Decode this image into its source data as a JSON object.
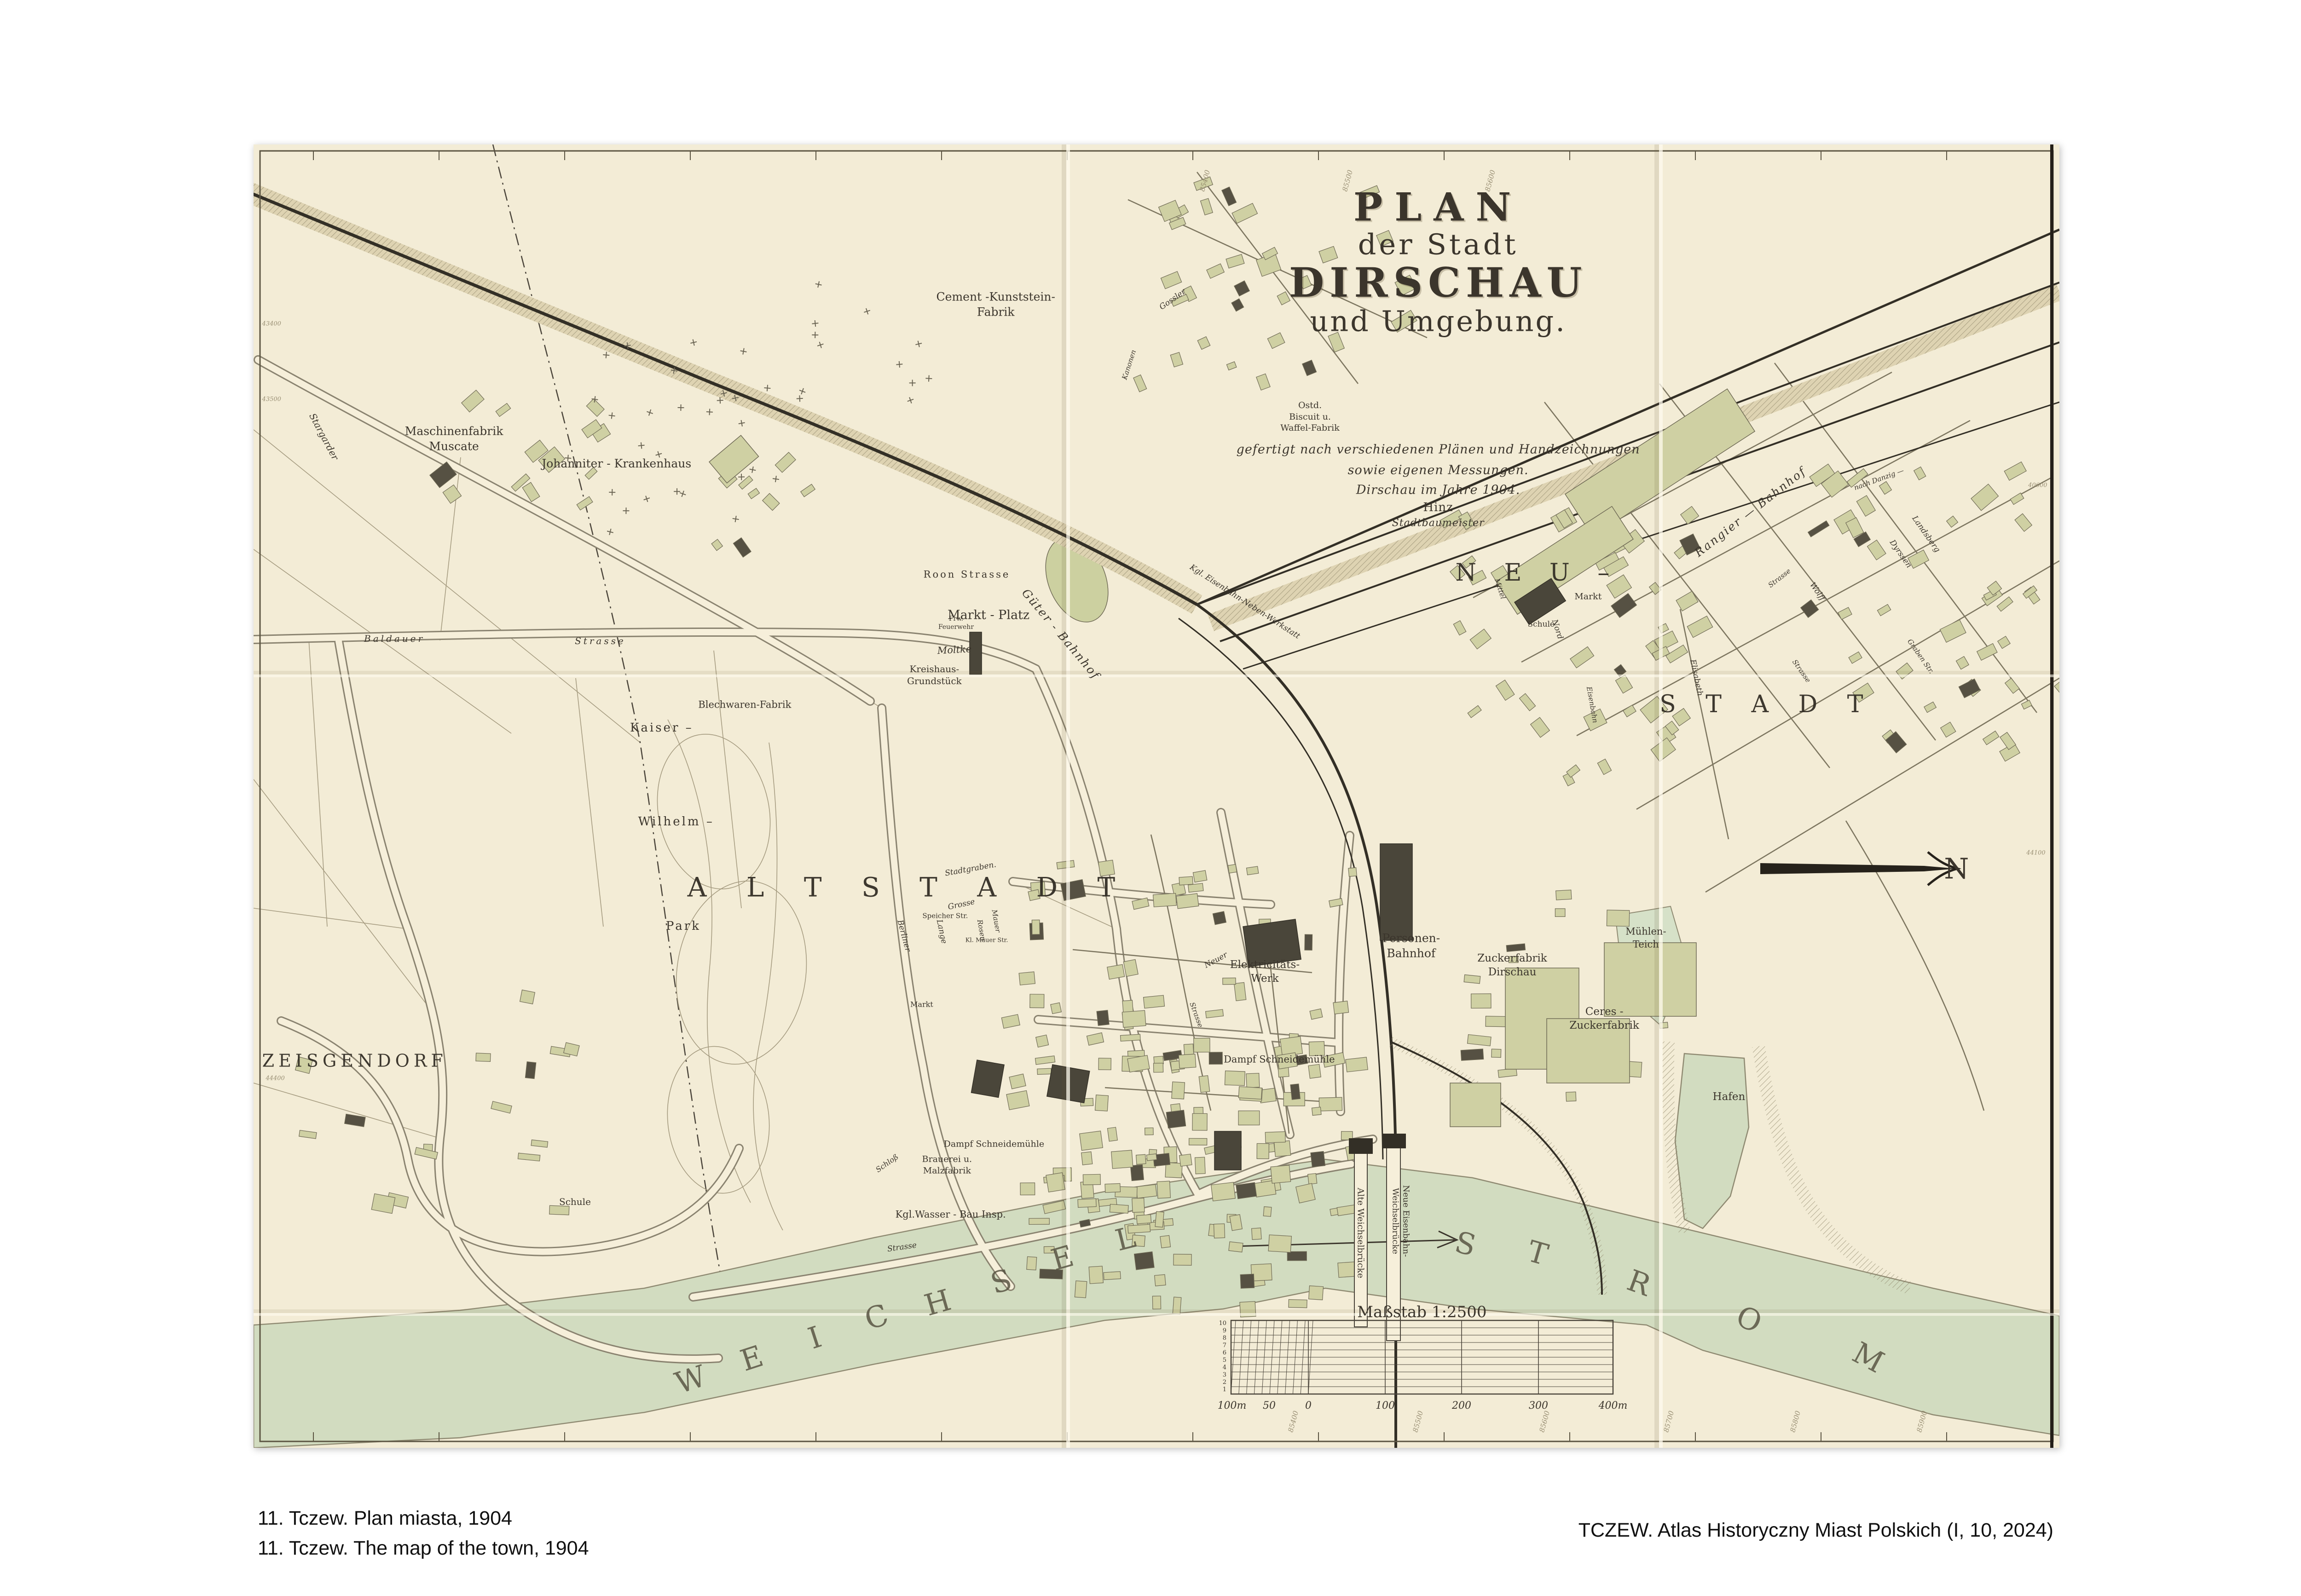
{
  "page": {
    "background": "#ffffff"
  },
  "captions": {
    "left": [
      "11. Tczew. Plan miasta, 1904",
      "11. Tczew. The map of the town, 1904"
    ],
    "right": "TCZEW. Atlas Historyczny Miast Polskich (I, 10, 2024)"
  },
  "map": {
    "colors": {
      "paper": "#f3ecd6",
      "river": "#d2dcc0",
      "pond": "#d6e1c8",
      "building": "#cfd0a3",
      "dark_building": "#4a463a",
      "ink": "#3b352c"
    },
    "title_block": {
      "x": 65.6,
      "lines": [
        {
          "text": "PLAN",
          "y": 4.8,
          "s": 84,
          "ls": 26,
          "cls": "b shadow"
        },
        {
          "text": "der Stadt",
          "y": 7.7,
          "s": 62,
          "ls": 6,
          "cls": ""
        },
        {
          "text": "DIRSCHAU",
          "y": 10.6,
          "s": 88,
          "ls": 12,
          "cls": "b shadow"
        },
        {
          "text": "und Umgebung.",
          "y": 13.6,
          "s": 62,
          "ls": 4,
          "cls": ""
        },
        {
          "text": "gefertigt nach verschiedenen Plänen und Handzeichnungen",
          "y": 23.4,
          "s": 27,
          "ls": 1,
          "cls": "it"
        },
        {
          "text": "sowie eigenen Messungen.",
          "y": 25.0,
          "s": 27,
          "ls": 1,
          "cls": "it"
        },
        {
          "text": "Dirschau im Jahre 1904.",
          "y": 26.5,
          "s": 27,
          "ls": 1,
          "cls": "it"
        },
        {
          "text": "Hinz",
          "y": 27.9,
          "s": 26,
          "ls": 1,
          "cls": ""
        },
        {
          "text": "Stadtbaumeister",
          "y": 29.1,
          "s": 22,
          "ls": 1,
          "cls": "it"
        }
      ]
    },
    "north_label": "N",
    "scale": {
      "title": "Maßstab 1:2500",
      "ticks": [
        "100m",
        "50",
        "0",
        "100",
        "200",
        "300",
        "400m"
      ],
      "rows": [
        "10",
        "9",
        "8",
        "7",
        "6",
        "5",
        "4",
        "3",
        "2",
        "1"
      ]
    },
    "labels": [
      {
        "t": "ZEISGENDORF",
        "x": 5.6,
        "y": 70.3,
        "s": 38,
        "ls": 9,
        "cls": "dist"
      },
      {
        "t": "A L T S T A D T",
        "x": 36.3,
        "y": 57.0,
        "s": 58,
        "ls": 34,
        "cls": "dist"
      },
      {
        "t": "N E U –",
        "x": 71.1,
        "y": 32.9,
        "s": 52,
        "ls": 22,
        "cls": "dist"
      },
      {
        "t": "S T A D T",
        "x": 83.8,
        "y": 43.0,
        "s": 52,
        "ls": 24,
        "cls": "dist"
      },
      {
        "t": "W",
        "x": 24.2,
        "y": 94.8,
        "s": 64,
        "r": -18,
        "cls": "river"
      },
      {
        "t": "E",
        "x": 27.6,
        "y": 93.2,
        "s": 64,
        "r": -18,
        "cls": "river"
      },
      {
        "t": "I",
        "x": 31.1,
        "y": 91.6,
        "s": 64,
        "r": -18,
        "cls": "river"
      },
      {
        "t": "C",
        "x": 34.5,
        "y": 90.0,
        "s": 64,
        "r": -18,
        "cls": "river"
      },
      {
        "t": "H",
        "x": 37.9,
        "y": 88.9,
        "s": 64,
        "r": -16,
        "cls": "river"
      },
      {
        "t": "S",
        "x": 41.4,
        "y": 87.3,
        "s": 64,
        "r": -16,
        "cls": "river"
      },
      {
        "t": "E",
        "x": 44.8,
        "y": 85.5,
        "s": 64,
        "r": -16,
        "cls": "river"
      },
      {
        "t": "L",
        "x": 48.3,
        "y": 84.0,
        "s": 64,
        "r": -14,
        "cls": "river"
      },
      {
        "t": "S",
        "x": 67.1,
        "y": 84.4,
        "s": 64,
        "r": 14,
        "cls": "river"
      },
      {
        "t": "T",
        "x": 71.1,
        "y": 85.1,
        "s": 64,
        "r": 16,
        "cls": "river"
      },
      {
        "t": "R",
        "x": 76.7,
        "y": 87.4,
        "s": 64,
        "r": 20,
        "cls": "river"
      },
      {
        "t": "O",
        "x": 82.8,
        "y": 90.2,
        "s": 64,
        "r": 24,
        "cls": "river"
      },
      {
        "t": "M",
        "x": 89.4,
        "y": 93.1,
        "s": 64,
        "r": 28,
        "cls": "river"
      },
      {
        "t": "Maschinenfabrik\nMuscate",
        "x": 11.1,
        "y": 22.6,
        "s": 25
      },
      {
        "t": "Johanniter - Krankenhaus",
        "x": 20.1,
        "y": 24.5,
        "s": 25
      },
      {
        "t": "Cement -Kunststein-\nFabrik",
        "x": 41.1,
        "y": 12.3,
        "s": 25
      },
      {
        "t": "Ostd.\nBiscuit u.\nWaffel-Fabrik",
        "x": 58.5,
        "y": 20.9,
        "s": 19
      },
      {
        "t": "Blechwaren-Fabrik",
        "x": 27.2,
        "y": 43.0,
        "s": 21
      },
      {
        "t": "Stargarder",
        "x": 3.9,
        "y": 22.4,
        "s": 20,
        "r": 62,
        "cls": "it"
      },
      {
        "t": "Baldauer",
        "x": 7.8,
        "y": 37.9,
        "s": 20,
        "ls": 5,
        "cls": "it"
      },
      {
        "t": "Strasse",
        "x": 19.2,
        "y": 38.1,
        "s": 20,
        "ls": 5,
        "cls": "it"
      },
      {
        "t": "Kaiser –",
        "x": 22.6,
        "y": 44.8,
        "s": 26,
        "ls": 4
      },
      {
        "t": "Wilhelm –",
        "x": 23.4,
        "y": 52.0,
        "s": 26,
        "ls": 4
      },
      {
        "t": "Park",
        "x": 23.8,
        "y": 60.0,
        "s": 26,
        "ls": 4
      },
      {
        "t": "Schule",
        "x": 17.8,
        "y": 81.1,
        "s": 20
      },
      {
        "t": "Roon  Strasse",
        "x": 39.5,
        "y": 33.0,
        "s": 21,
        "ls": 4
      },
      {
        "t": "Markt - Platz",
        "x": 40.7,
        "y": 36.1,
        "s": 27
      },
      {
        "t": "Frw.\nFeuerwehr",
        "x": 38.9,
        "y": 36.7,
        "s": 14
      },
      {
        "t": "Moltke",
        "x": 38.8,
        "y": 38.8,
        "s": 21,
        "r": -3,
        "cls": "it"
      },
      {
        "t": "Kreishaus-\nGrundstück",
        "x": 37.7,
        "y": 40.7,
        "s": 20
      },
      {
        "t": "Stadtgraben.",
        "x": 39.7,
        "y": 55.6,
        "s": 17,
        "r": -10,
        "cls": "it"
      },
      {
        "t": "Grosse",
        "x": 39.2,
        "y": 58.3,
        "s": 17,
        "r": -12,
        "cls": "it"
      },
      {
        "t": "Speicher Str.",
        "x": 38.3,
        "y": 59.2,
        "s": 15
      },
      {
        "t": "Lange",
        "x": 38.1,
        "y": 60.4,
        "s": 17,
        "r": 78,
        "cls": "it"
      },
      {
        "t": "Rosen",
        "x": 40.3,
        "y": 60.3,
        "s": 15,
        "r": 80,
        "cls": "it"
      },
      {
        "t": "Mauer",
        "x": 41.1,
        "y": 59.6,
        "s": 15,
        "r": 80,
        "cls": "it"
      },
      {
        "t": "Kl. Mauer Str.",
        "x": 40.6,
        "y": 61.1,
        "s": 13
      },
      {
        "t": "Berliner",
        "x": 36.0,
        "y": 60.7,
        "s": 17,
        "r": 75,
        "cls": "it"
      },
      {
        "t": "Markt",
        "x": 37.0,
        "y": 66.0,
        "s": 16
      },
      {
        "t": "Schloß",
        "x": 35.1,
        "y": 78.2,
        "s": 16,
        "r": -35,
        "cls": "it"
      },
      {
        "t": "Brauerei u.\nMalzfabrik",
        "x": 38.4,
        "y": 78.3,
        "s": 19
      },
      {
        "t": "Kgl.Wasser - Bau Insp.",
        "x": 38.6,
        "y": 82.1,
        "s": 21
      },
      {
        "t": "Dampf Schneidemühle",
        "x": 41.0,
        "y": 76.7,
        "s": 19
      },
      {
        "t": "Strasse",
        "x": 35.9,
        "y": 84.6,
        "s": 17,
        "r": -8,
        "cls": "it"
      },
      {
        "t": "Dampf  Schneidemühle",
        "x": 56.8,
        "y": 70.2,
        "s": 21
      },
      {
        "t": "Elektricitäts-\nWerk",
        "x": 56.0,
        "y": 63.5,
        "s": 23
      },
      {
        "t": "Neuer",
        "x": 53.3,
        "y": 62.6,
        "s": 17,
        "r": -28,
        "cls": "it"
      },
      {
        "t": "Strasse",
        "x": 52.2,
        "y": 66.8,
        "s": 15,
        "r": 70,
        "cls": "it"
      },
      {
        "t": "Personen-\nBahnhof",
        "x": 64.1,
        "y": 61.5,
        "s": 25
      },
      {
        "t": "Zuckerfabrik\nDirschau",
        "x": 69.7,
        "y": 63.0,
        "s": 23
      },
      {
        "t": "Ceres -\nZuckerfabrik",
        "x": 74.8,
        "y": 67.1,
        "s": 23
      },
      {
        "t": "Mühlen-\nTeich",
        "x": 77.1,
        "y": 60.9,
        "s": 21
      },
      {
        "t": "Hafen",
        "x": 81.7,
        "y": 73.1,
        "s": 23
      },
      {
        "t": "Alte  Weichselbrücke",
        "x": 61.3,
        "y": 83.5,
        "s": 19,
        "r": 90
      },
      {
        "t": "Neue Eisenbahn-\nWeichselbrücke",
        "x": 63.5,
        "y": 82.6,
        "s": 18,
        "r": 90
      },
      {
        "t": "Güter - Bahnhof",
        "x": 44.7,
        "y": 37.6,
        "s": 25,
        "ls": 3,
        "r": 50,
        "cls": "it"
      },
      {
        "t": "Kgl. Eisenbahn-Neben-Werkstatt",
        "x": 54.9,
        "y": 35.1,
        "s": 17,
        "r": 33,
        "cls": "it"
      },
      {
        "t": "Rangier — Bahnhof",
        "x": 82.9,
        "y": 28.2,
        "s": 25,
        "ls": 3,
        "r": -38,
        "cls": "it"
      },
      {
        "t": "nach Danzig —",
        "x": 90.0,
        "y": 25.7,
        "s": 15,
        "r": -20,
        "cls": "it"
      },
      {
        "t": "Landsberg",
        "x": 92.6,
        "y": 29.9,
        "s": 17,
        "r": 55,
        "cls": "it"
      },
      {
        "t": "Dyrssen",
        "x": 91.2,
        "y": 31.4,
        "s": 17,
        "r": 55,
        "cls": "it"
      },
      {
        "t": "Wolff",
        "x": 86.6,
        "y": 34.3,
        "s": 17,
        "r": 55,
        "cls": "it"
      },
      {
        "t": "Elisabeth",
        "x": 79.9,
        "y": 40.9,
        "s": 17,
        "r": 78,
        "cls": "it"
      },
      {
        "t": "Nord",
        "x": 72.2,
        "y": 37.2,
        "s": 17,
        "r": 72,
        "cls": "it"
      },
      {
        "t": "Mittel",
        "x": 69.0,
        "y": 34.1,
        "s": 15,
        "r": 72,
        "cls": "it"
      },
      {
        "t": "Eisenbahn",
        "x": 74.1,
        "y": 43.0,
        "s": 15,
        "r": 80,
        "cls": "it"
      },
      {
        "t": "Markt",
        "x": 73.9,
        "y": 34.7,
        "s": 19
      },
      {
        "t": "Schule",
        "x": 71.3,
        "y": 36.8,
        "s": 17
      },
      {
        "t": "Strasse",
        "x": 84.5,
        "y": 33.3,
        "s": 15,
        "r": -38,
        "cls": "it"
      },
      {
        "t": "Strasse",
        "x": 85.7,
        "y": 40.4,
        "s": 15,
        "r": 55,
        "cls": "it"
      },
      {
        "t": "Graben Str.",
        "x": 92.3,
        "y": 39.3,
        "s": 15,
        "r": 55,
        "cls": "it"
      },
      {
        "t": "Gossler",
        "x": 50.9,
        "y": 11.9,
        "s": 17,
        "r": -35,
        "cls": "it"
      },
      {
        "t": "Kanonen",
        "x": 48.5,
        "y": 16.9,
        "s": 15,
        "r": -72,
        "cls": "it"
      },
      {
        "t": "Maßstab 1:2500",
        "x": 64.7,
        "y": 89.6,
        "s": 34
      },
      {
        "t": "85400",
        "x": 57.6,
        "y": 98.0,
        "s": 15,
        "r": -75,
        "cls": "faint it"
      },
      {
        "t": "85500",
        "x": 64.5,
        "y": 98.0,
        "s": 15,
        "r": -75,
        "cls": "faint it"
      },
      {
        "t": "85600",
        "x": 71.5,
        "y": 98.0,
        "s": 15,
        "r": -75,
        "cls": "faint it"
      },
      {
        "t": "85700",
        "x": 78.4,
        "y": 98.0,
        "s": 15,
        "r": -75,
        "cls": "faint it"
      },
      {
        "t": "85800",
        "x": 85.4,
        "y": 98.0,
        "s": 15,
        "r": -75,
        "cls": "faint it"
      },
      {
        "t": "85900",
        "x": 92.4,
        "y": 98.0,
        "s": 15,
        "r": -75,
        "cls": "faint it"
      },
      {
        "t": "85400",
        "x": 52.7,
        "y": 2.8,
        "s": 15,
        "r": -75,
        "cls": "faint it"
      },
      {
        "t": "85500",
        "x": 60.6,
        "y": 2.8,
        "s": 15,
        "r": -75,
        "cls": "faint it"
      },
      {
        "t": "85600",
        "x": 68.5,
        "y": 2.8,
        "s": 15,
        "r": -75,
        "cls": "faint it"
      },
      {
        "t": "43400",
        "x": 1.0,
        "y": 13.8,
        "s": 13,
        "cls": "faint it"
      },
      {
        "t": "43500",
        "x": 1.0,
        "y": 19.6,
        "s": 13,
        "cls": "faint it"
      },
      {
        "t": "44400",
        "x": 1.2,
        "y": 71.7,
        "s": 13,
        "cls": "faint it"
      },
      {
        "t": "40600",
        "x": 98.8,
        "y": 26.2,
        "s": 13,
        "cls": "faint it"
      },
      {
        "t": "44100",
        "x": 98.7,
        "y": 54.4,
        "s": 13,
        "cls": "faint it"
      }
    ]
  }
}
